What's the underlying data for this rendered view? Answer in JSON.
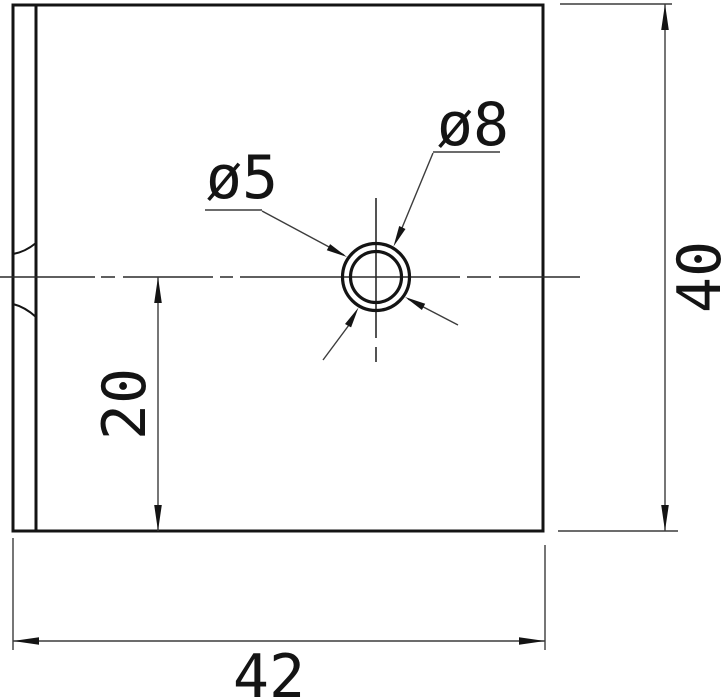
{
  "drawing": {
    "type": "engineering-dimension-drawing",
    "part": "rectangular plate with counterbored center hole",
    "labels": {
      "hole_diameter": "ø5",
      "counterbore_diameter": "ø8",
      "center_offset": "20",
      "plate_width": "42",
      "plate_height": "40"
    },
    "values": {
      "hole_diameter_mm": 5,
      "counterbore_diameter_mm": 8,
      "center_offset_mm": 20,
      "plate_width_mm": 42,
      "plate_height_mm": 40
    },
    "colors": {
      "background": "#ffffff",
      "outline": "#141414",
      "thin_line": "#3c3c3c",
      "centerline": "#2a2a2a",
      "text": "#141414"
    }
  }
}
